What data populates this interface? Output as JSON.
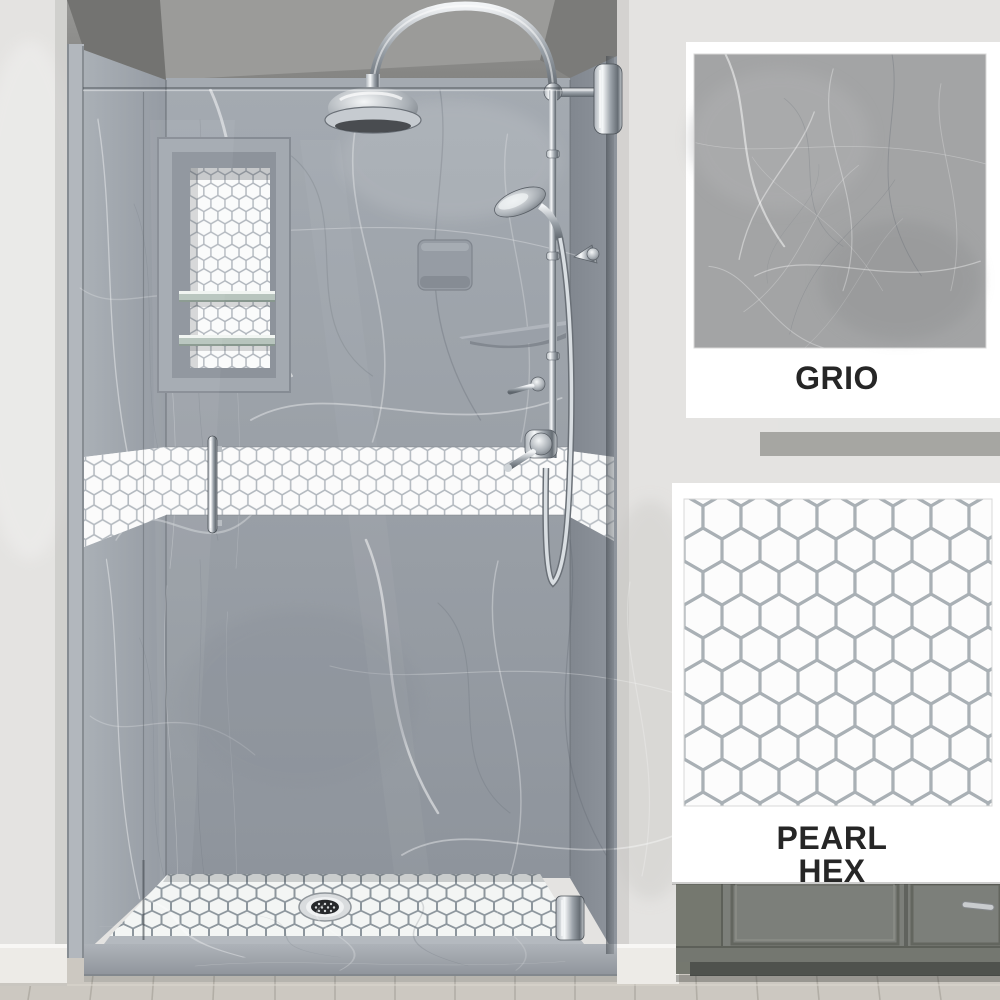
{
  "page": {
    "title": "Alcove shower product photo with finish swatches"
  },
  "swatches": [
    {
      "id": "wall-finish",
      "label": "GRIO",
      "description": "gray marble wall panel finish swatch",
      "swatch_color": "#a3a4a5"
    },
    {
      "id": "accent-tile-finish",
      "label": "PEARL HEX",
      "lines": [
        "PEARL",
        "HEX"
      ],
      "description": "white hexagon mosaic tile finish swatch",
      "tile_color": "#fbfbfb",
      "grout_color": "#aab0b5"
    }
  ],
  "colors": {
    "room_wall": "#e4e3e1",
    "alcove_upper_wall": "#8a8a88",
    "marble_wall": "#9aa0a7",
    "hex_tile": "#fbfbfb",
    "hex_grout": "#b3b9bf",
    "chrome": "#c9ced3",
    "label_text": "#262626",
    "vanity": "#7c7f7a",
    "wood_floor": "#ccc8c1",
    "baseboard": "#edebe7"
  }
}
